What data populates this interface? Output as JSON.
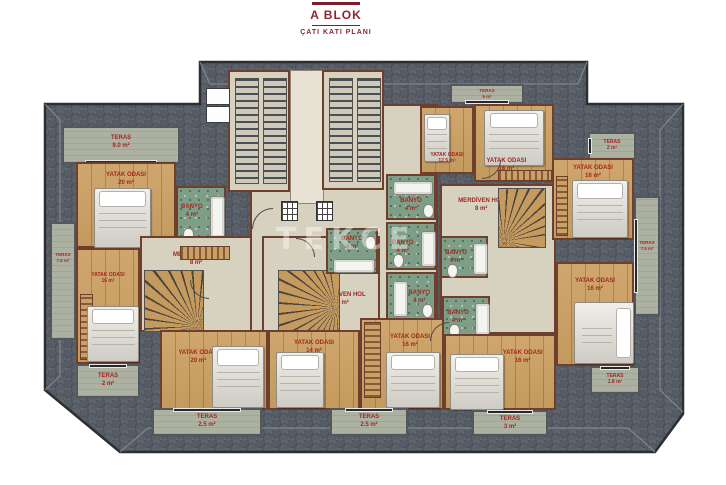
{
  "title": {
    "block": "A BLOK",
    "plan": "ÇATI KATI PLANI"
  },
  "watermark": "TEKCE",
  "colors": {
    "label_red": "#a02820",
    "title_red": "#8f2430",
    "roof_gray": "#5c626b",
    "wood_floor": "#c9a267",
    "bath_green": "#7e9e88",
    "teras_gray": "#adb1a2",
    "wall_brown": "#6e3f2c"
  },
  "rooms": {
    "teras_tl": {
      "name": "TERAS",
      "area": "9.0 m²"
    },
    "bed_tl": {
      "name": "YATAK ODASI",
      "area": "20 m²"
    },
    "banyo_tl": {
      "name": "BANYO",
      "area": "4 m²"
    },
    "teras_left": {
      "name": "TERAS",
      "area": "7.5 m²"
    },
    "bed_ml": {
      "name": "YATAK ODASI",
      "area": "16 m²"
    },
    "merdiven_left": {
      "name": "MERDİVEN HOL",
      "area": "8 m²"
    },
    "teras_bl": {
      "name": "TERAS",
      "area": "2 m²"
    },
    "bed_bl": {
      "name": "YATAK ODASI",
      "area": "20 m²"
    },
    "teras_b1": {
      "name": "TERAS",
      "area": "2.5 m²"
    },
    "bed_b3": {
      "name": "YATAK ODASI",
      "area": "14 m²"
    },
    "teras_b2": {
      "name": "TERAS",
      "area": "2.5 m²"
    },
    "bed_b4": {
      "name": "YATAK ODASI",
      "area": "16 m²"
    },
    "bed_b5": {
      "name": "YATAK ODASI",
      "area": "16 m²"
    },
    "teras_b3": {
      "name": "TERAS",
      "area": "3 m²"
    },
    "banyo_c1": {
      "name": "BANYO",
      "area": "4 m²"
    },
    "banyo_c2": {
      "name": "BANYO",
      "area": "4 m²"
    },
    "banyo_c3": {
      "name": "BANYO",
      "area": "4 m²"
    },
    "banyo_c4": {
      "name": "BANYO",
      "area": "4 m²"
    },
    "banyo_r1": {
      "name": "BANYO",
      "area": "4 m²"
    },
    "banyo_r2": {
      "name": "BANYO",
      "area": "4 m²"
    },
    "merdiven_center": {
      "name": "MERDİVEN HOL",
      "area": "8 m²"
    },
    "merdiven_right": {
      "name": "MERDİVEN HOL",
      "area": "8 m²"
    },
    "bed_top_c": {
      "name": "YATAK ODASI",
      "area": "12.5 m²"
    },
    "bed_top_r": {
      "name": "YATAK ODASI",
      "area": "16 m²"
    },
    "teras_tc": {
      "name": "TERAS",
      "area": "5 m²"
    },
    "teras_tr": {
      "name": "TERAS",
      "area": "2 m²"
    },
    "bed_r1": {
      "name": "YATAK ODASI",
      "area": "16 m²"
    },
    "teras_right": {
      "name": "TERAS",
      "area": "7.5 m²"
    },
    "bed_r2": {
      "name": "YATAK ODASI",
      "area": "16 m²"
    },
    "teras_br": {
      "name": "TERAS",
      "area": "1.8 m²"
    }
  }
}
